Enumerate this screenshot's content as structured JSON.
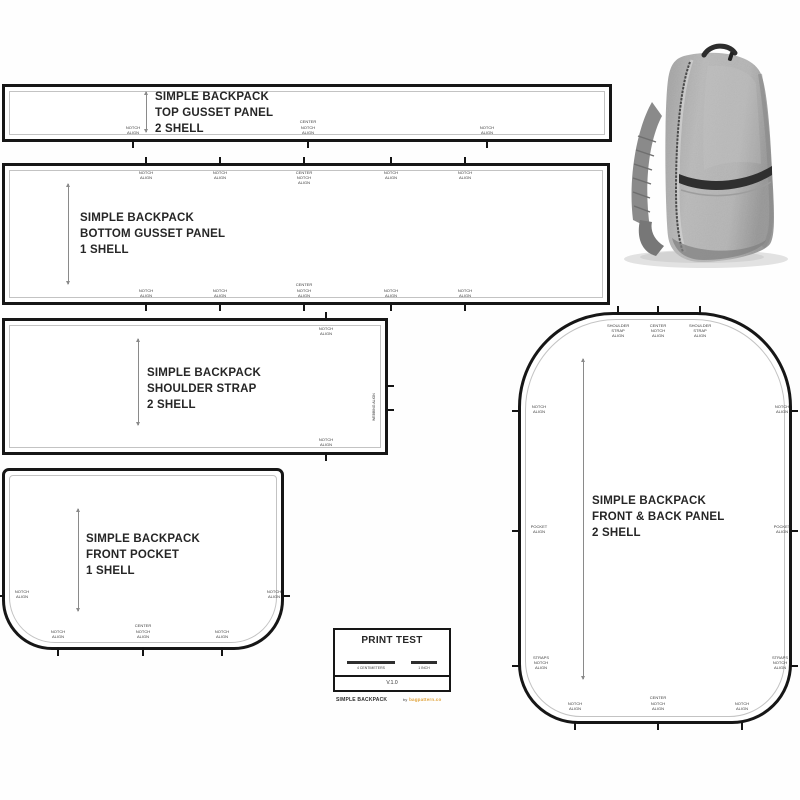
{
  "colors": {
    "outline": "#161616",
    "inner_line": "#c3c3c3",
    "label_text": "#3a3a3a",
    "credit_orange": "#e0a33b",
    "backpack_gray": "#a8a8a8"
  },
  "pieces": {
    "top_gusset": {
      "title": [
        "SIMPLE BACKPACK",
        "TOP GUSSET PANEL",
        "2 SHELL"
      ],
      "bottom_notches": [
        "NOTCH ALIGN",
        "CENTER NOTCH ALIGN",
        "NOTCH ALIGN"
      ]
    },
    "bottom_gusset": {
      "title": [
        "SIMPLE BACKPACK",
        "BOTTOM GUSSET PANEL",
        "1 SHELL"
      ],
      "top_notches": [
        "NOTCH ALIGN",
        "NOTCH ALIGN",
        "CENTER NOTCH ALIGN",
        "NOTCH ALIGN",
        "NOTCH ALIGN"
      ],
      "bottom_notches": [
        "NOTCH ALIGN",
        "NOTCH ALIGN",
        "CENTER NOTCH ALIGN",
        "NOTCH ALIGN",
        "NOTCH ALIGN"
      ]
    },
    "shoulder_strap": {
      "title": [
        "SIMPLE BACKPACK",
        "SHOULDER STRAP",
        "2 SHELL"
      ],
      "top_notch": "NOTCH ALIGN",
      "bottom_notch": "NOTCH ALIGN",
      "side_text": "WEBBING ALIGN"
    },
    "front_pocket": {
      "title": [
        "SIMPLE BACKPACK",
        "FRONT POCKET",
        "1 SHELL"
      ],
      "left_notch": "NOTCH ALIGN",
      "right_notch": "NOTCH ALIGN",
      "bottom_notches": [
        "NOTCH ALIGN",
        "CENTER NOTCH ALIGN",
        "NOTCH ALIGN"
      ]
    },
    "front_back_panel": {
      "title": [
        "SIMPLE BACKPACK",
        "FRONT & BACK PANEL",
        "2 SHELL"
      ],
      "top_notches": [
        "SHOULDER STRAP ALIGN",
        "CENTER NOTCH ALIGN",
        "SHOULDER STRAP ALIGN"
      ],
      "left_notches": [
        "NOTCH ALIGN",
        "POCKET ALIGN",
        "STRAPS NOTCH ALIGN"
      ],
      "right_notches": [
        "NOTCH ALIGN",
        "POCKET ALIGN",
        "STRAPS NOTCH ALIGN"
      ],
      "bottom_notches": [
        "NOTCH ALIGN",
        "CENTER NOTCH ALIGN",
        "NOTCH ALIGN"
      ]
    }
  },
  "print_test": {
    "title": "PRINT TEST",
    "bars": [
      {
        "label": "4 CENTIMETERS"
      },
      {
        "label": "1 INCH"
      }
    ],
    "version": "V.1.0",
    "footer_left": "SIMPLE BACKPACK",
    "footer_by": "by",
    "footer_credit": "bagpattern.co"
  },
  "photo": {
    "name": "grey-backpack-photo"
  }
}
